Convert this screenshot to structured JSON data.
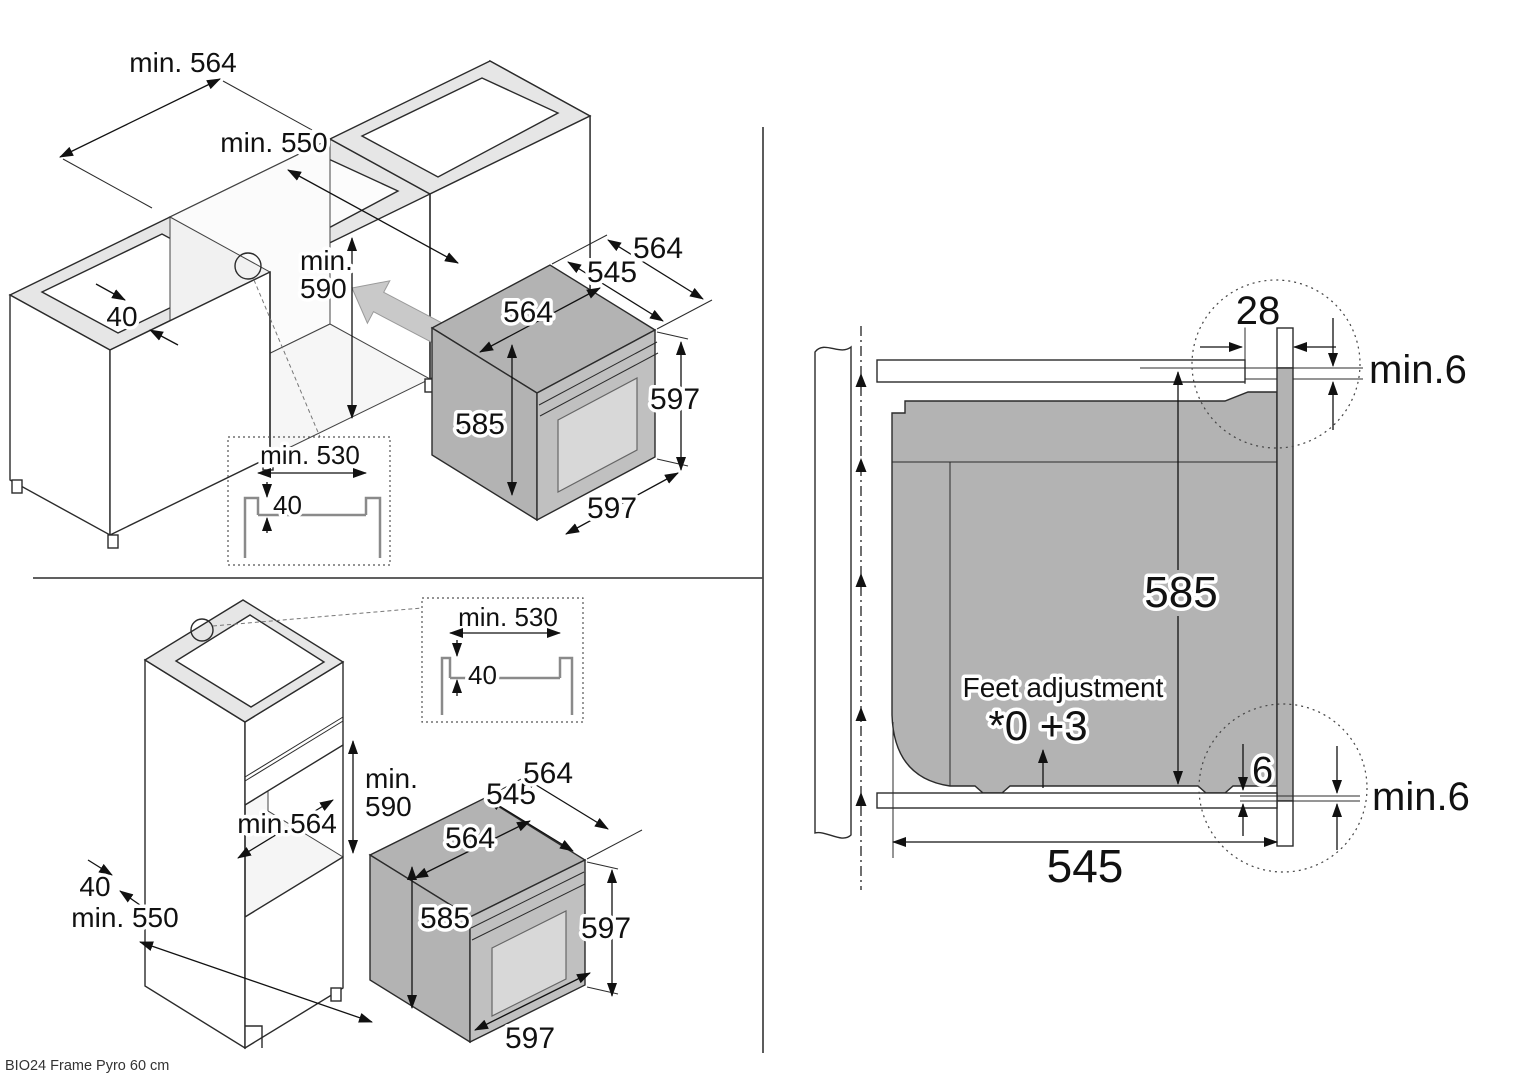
{
  "footer": {
    "model_label": "BIO24 Frame Pyro 60 cm"
  },
  "panel_base_cabinet": {
    "dim_niche_width": "min. 564",
    "dim_niche_depth": "min. 550",
    "dim_niche_height_line1": "min.",
    "dim_niche_height_line2": "590",
    "dim_rail_thickness": "40",
    "inset": {
      "dim_width": "min. 530",
      "dim_depth": "40"
    },
    "oven": {
      "dim_top_width": "564",
      "dim_body_depth": "545",
      "dim_total_depth": "564",
      "dim_body_height": "585",
      "dim_front_height": "597",
      "dim_front_width": "597"
    }
  },
  "panel_tall_cabinet": {
    "dim_niche_height_line1": "min.",
    "dim_niche_height_line2": "590",
    "dim_niche_width": "min.564",
    "dim_rail_thickness": "40",
    "dim_niche_depth": "min. 550",
    "inset": {
      "dim_width": "min. 530",
      "dim_depth": "40"
    },
    "oven": {
      "dim_top_width": "564",
      "dim_body_depth": "545",
      "dim_total_depth": "564",
      "dim_body_height": "585",
      "dim_front_height": "597",
      "dim_front_width": "597"
    }
  },
  "panel_cross_section": {
    "dim_frame_overlap": "28",
    "dim_top_gap": "min.6",
    "dim_body_height": "585",
    "feet_note_title": "Feet adjustment",
    "feet_note_values": "*0 +3",
    "dim_bottom_overlap": "6",
    "dim_bottom_gap": "min.6",
    "dim_body_depth": "545"
  }
}
